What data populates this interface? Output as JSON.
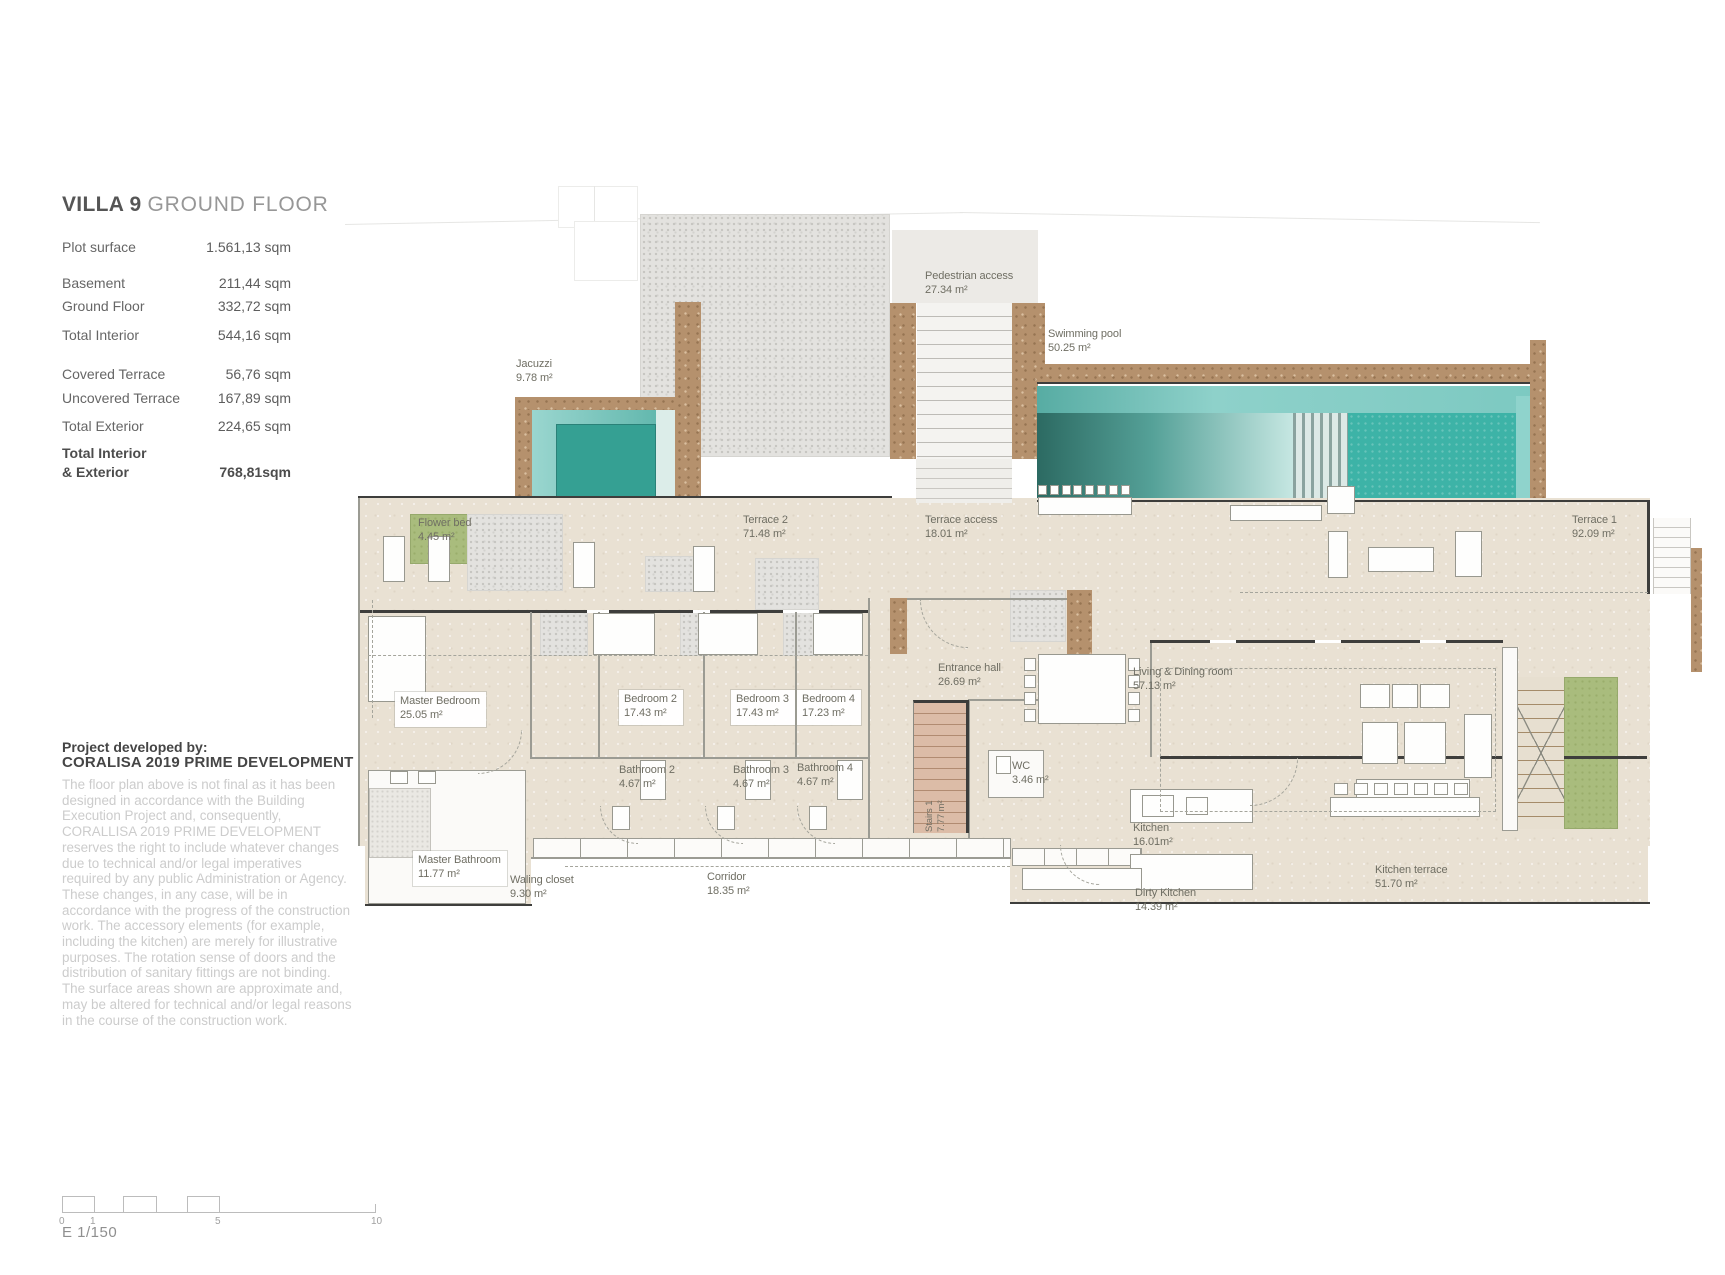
{
  "panel": {
    "title": {
      "bold": "VILLA 9",
      "light": "GROUND FLOOR"
    },
    "stats": [
      {
        "label": "Plot surface",
        "value": "1.561,13 sqm",
        "mt": 0,
        "bold": false
      },
      {
        "label": "Basement",
        "value": "211,44 sqm",
        "mt": 17,
        "bold": false
      },
      {
        "label": "Ground Floor",
        "value": "332,72 sqm",
        "mt": 4,
        "bold": false
      },
      {
        "label": "Total Interior",
        "value": "544,16 sqm",
        "mt": 10,
        "bold": false
      },
      {
        "label": "Covered Terrace",
        "value": "56,76 sqm",
        "mt": 20,
        "bold": false
      },
      {
        "label": "Uncovered Terrace",
        "value": "167,89 sqm",
        "mt": 5,
        "bold": false
      },
      {
        "label": "Total Exterior",
        "value": "224,65 sqm",
        "mt": 9,
        "bold": false
      },
      {
        "label": "Total Interior\n& Exterior",
        "value": "768,81sqm",
        "mt": 8,
        "bold": true
      }
    ],
    "developer": {
      "heading": "Project developed by:",
      "name": "CORALISA 2019 PRIME DEVELOPMENT"
    },
    "disclaimer": "The floor plan above is not final as it has been designed in accordance with the Building Execution Project and, consequently, CORALLISA 2019 PRIME DEVELOPMENT reserves the right to include whatever changes due to technical and/or legal imperatives required by any public Administration or Agency. These changes, in any case, will be in accordance with the progress of the construction work. The accessory elements (for example, including the kitchen) are merely for illustrative purposes. The rotation sense of doors and the distribution of sanitary fittings are not binding. The surface areas shown are approximate and, may be altered for technical and/or legal reasons in the course of the construction work.",
    "scale": {
      "ticks": [
        {
          "label": "0",
          "off": 0
        },
        {
          "label": "1",
          "off": 31
        },
        {
          "label": "5",
          "off": 156
        },
        {
          "label": "10",
          "off": 312
        }
      ],
      "caption": "E 1/150"
    }
  },
  "plan": {
    "rooms": [
      {
        "id": "pedestrian-access",
        "name": "Pedestrian access",
        "area": "27.34 m²",
        "x": 925,
        "y": 270
      },
      {
        "id": "swimming-pool",
        "name": "Swimming pool",
        "area": "50.25 m²",
        "x": 1048,
        "y": 328
      },
      {
        "id": "jacuzzi",
        "name": "Jacuzzi",
        "area": "9.78 m²",
        "x": 516,
        "y": 358
      },
      {
        "id": "flower-bed",
        "name": "Flower bed",
        "area": "4.45 m²",
        "x": 418,
        "y": 517
      },
      {
        "id": "terrace-2",
        "name": "Terrace 2",
        "area": "71.48 m²",
        "x": 743,
        "y": 514
      },
      {
        "id": "terrace-access",
        "name": "Terrace access",
        "area": "18.01 m²",
        "x": 925,
        "y": 514
      },
      {
        "id": "terrace-1",
        "name": "Terrace 1",
        "area": "92.09 m²",
        "x": 1572,
        "y": 514
      },
      {
        "id": "master-bedroom",
        "name": "Master Bedroom",
        "area": "25.05 m²",
        "x": 395,
        "y": 692,
        "box": true
      },
      {
        "id": "bedroom-2",
        "name": "Bedroom 2",
        "area": "17.43 m²",
        "x": 619,
        "y": 690,
        "box": true
      },
      {
        "id": "bedroom-3",
        "name": "Bedroom 3",
        "area": "17.43 m²",
        "x": 731,
        "y": 690,
        "box": true
      },
      {
        "id": "bedroom-4",
        "name": "Bedroom 4",
        "area": "17.23 m²",
        "x": 797,
        "y": 690,
        "box": true
      },
      {
        "id": "entrance-hall",
        "name": "Entrance hall",
        "area": "26.69 m²",
        "x": 938,
        "y": 662
      },
      {
        "id": "living-dining",
        "name": "Living & Dining room",
        "area": "57.13 m²",
        "x": 1133,
        "y": 666
      },
      {
        "id": "bathroom-2",
        "name": "Bathroom 2",
        "area": "4.67 m²",
        "x": 619,
        "y": 764
      },
      {
        "id": "bathroom-3",
        "name": "Bathroom 3",
        "area": "4.67 m²",
        "x": 733,
        "y": 764
      },
      {
        "id": "bathroom-4",
        "name": "Bathroom 4",
        "area": "4.67 m²",
        "x": 797,
        "y": 762
      },
      {
        "id": "wc",
        "name": "WC",
        "area": "3.46 m²",
        "x": 1012,
        "y": 760
      },
      {
        "id": "stairs-1",
        "name": "Stairs 1",
        "area": "7.77 m²",
        "x": 924,
        "y": 832,
        "rot": true
      },
      {
        "id": "kitchen",
        "name": "Kitchen",
        "area": "16.01m²",
        "x": 1133,
        "y": 822
      },
      {
        "id": "dirty-kitchen",
        "name": "Dirty Kitchen",
        "area": "14.39 m²",
        "x": 1135,
        "y": 887
      },
      {
        "id": "kitchen-terrace",
        "name": "Kitchen terrace",
        "area": "51.70 m²",
        "x": 1375,
        "y": 864
      },
      {
        "id": "master-bathroom",
        "name": "Master Bathroom",
        "area": "11.77 m²",
        "x": 413,
        "y": 851,
        "box": true
      },
      {
        "id": "waling-closet",
        "name": "Waling closet",
        "area": "9.30 m²",
        "x": 510,
        "y": 874
      },
      {
        "id": "corridor",
        "name": "Corridor",
        "area": "18.35 m²",
        "x": 707,
        "y": 871,
        "narrow": true
      }
    ],
    "colors": {
      "floor_beige": "#e9e1d3",
      "wall_brown": "#b5916d",
      "pool_teal": "#3db3a7",
      "pool_deep": "#2c6a62",
      "jacuzzi_teal": "#35a093",
      "garden_green": "#a9bc7d",
      "gravel_gray": "#e3e2df",
      "label_text": "#6f6e63"
    }
  }
}
